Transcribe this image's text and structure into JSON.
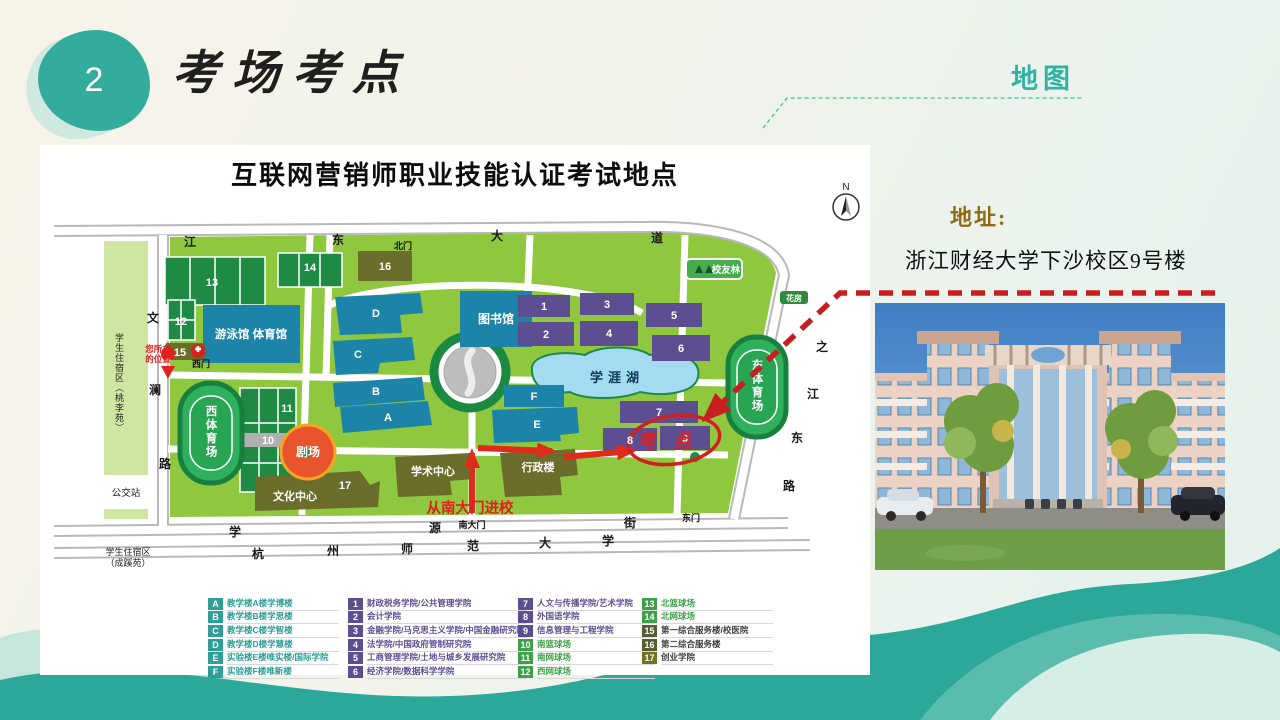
{
  "slide": {
    "number": "2",
    "title": "考场考点",
    "tab": "地图"
  },
  "address": {
    "label": "地址:",
    "value": "浙江财经大学下沙校区9号楼"
  },
  "map": {
    "title": "互联网营销师职业技能认证考试地点",
    "compass": "N",
    "gates": {
      "north": "北门",
      "south": "南大门",
      "east": "东门",
      "west": "西门"
    },
    "roads": {
      "top": [
        "江",
        "东",
        "大",
        "道"
      ],
      "right": [
        "之",
        "江",
        "东",
        "路"
      ],
      "left": [
        "文",
        "澜",
        "路"
      ],
      "street": [
        "学",
        "源",
        "街"
      ],
      "university": [
        "杭",
        "州",
        "师",
        "范",
        "大",
        "学"
      ]
    },
    "places": {
      "swim": "游泳馆 体育馆",
      "library": "图书馆",
      "lake": "学涯湖",
      "west_stadium": "西体育场",
      "east_stadium": "东体育场",
      "alumni": "校友林",
      "flower": "花房",
      "theater": "剧场",
      "culture": "文化中心",
      "academic": "学术中心",
      "admin": "行政楼",
      "exam": "考点",
      "route": "从南大门进校",
      "you_are_here_1": "您所在",
      "you_are_here_2": "的位置",
      "bus": "公交站",
      "dorm_west": "学生住宿区（桃李苑）",
      "dorm_south_1": "学生住宿区",
      "dorm_south_2": "（成蹊苑）"
    },
    "ids": {
      "A": "A",
      "B": "B",
      "C": "C",
      "D": "D",
      "E": "E",
      "F": "F",
      "n1": "1",
      "n2": "2",
      "n3": "3",
      "n4": "4",
      "n5": "5",
      "n6": "6",
      "n7": "7",
      "n8": "8",
      "n9": "9",
      "n10": "10",
      "n11": "11",
      "n12": "12",
      "n13": "13",
      "n14": "14",
      "n15": "15",
      "n16": "16",
      "n17": "17"
    }
  },
  "legend": {
    "columns": [
      {
        "items": [
          {
            "code": "A",
            "label": "教学楼A楼学博楼",
            "badge": "#2e9e97",
            "fg": "#2e9e97"
          },
          {
            "code": "B",
            "label": "教学楼B楼学思楼",
            "badge": "#2e9e97",
            "fg": "#2e9e97"
          },
          {
            "code": "C",
            "label": "教学楼C楼学智楼",
            "badge": "#2e9e97",
            "fg": "#2e9e97"
          },
          {
            "code": "D",
            "label": "教学楼D楼学慧楼",
            "badge": "#2e9e97",
            "fg": "#2e9e97"
          },
          {
            "code": "E",
            "label": "实验楼E楼唯实楼/国际学院",
            "badge": "#2e9e97",
            "fg": "#2e9e97"
          },
          {
            "code": "F",
            "label": "实验楼F楼唯新楼",
            "badge": "#2e9e97",
            "fg": "#2e9e97"
          }
        ]
      },
      {
        "items": [
          {
            "code": "1",
            "label": "财政税务学院/公共管理学院",
            "badge": "#5c4e90",
            "fg": "#5c4e90"
          },
          {
            "code": "2",
            "label": "会计学院",
            "badge": "#5c4e90",
            "fg": "#5c4e90"
          },
          {
            "code": "3",
            "label": "金融学院/马克思主义学院/中国金融研究院",
            "badge": "#5c4e90",
            "fg": "#5c4e90"
          },
          {
            "code": "4",
            "label": "法学院/中国政府管制研究院",
            "badge": "#5c4e90",
            "fg": "#5c4e90"
          },
          {
            "code": "5",
            "label": "工商管理学院/土地与城乡发展研究院",
            "badge": "#5c4e90",
            "fg": "#5c4e90"
          },
          {
            "code": "6",
            "label": "经济学院/数据科学学院",
            "badge": "#5c4e90",
            "fg": "#5c4e90"
          }
        ]
      },
      {
        "items": [
          {
            "code": "7",
            "label": "人文与传播学院/艺术学院",
            "badge": "#5c4e90",
            "fg": "#5c4e90"
          },
          {
            "code": "8",
            "label": "外国语学院",
            "badge": "#5c4e90",
            "fg": "#5c4e90"
          },
          {
            "code": "9",
            "label": "信息管理与工程学院",
            "badge": "#5c4e90",
            "fg": "#5c4e90"
          },
          {
            "code": "10",
            "label": "南篮球场",
            "badge": "#3fa04a",
            "fg": "#3fa04a"
          },
          {
            "code": "11",
            "label": "南网球场",
            "badge": "#3fa04a",
            "fg": "#3fa04a"
          },
          {
            "code": "12",
            "label": "西网球场",
            "badge": "#3fa04a",
            "fg": "#3fa04a"
          }
        ]
      },
      {
        "items": [
          {
            "code": "13",
            "label": "北篮球场",
            "badge": "#3fa04a",
            "fg": "#3fa04a"
          },
          {
            "code": "14",
            "label": "北网球场",
            "badge": "#3fa04a",
            "fg": "#3fa04a"
          },
          {
            "code": "15",
            "label": "第一综合服务楼/校医院",
            "badge": "#585c36",
            "fg": "#3f3f3f"
          },
          {
            "code": "16",
            "label": "第二综合服务楼",
            "badge": "#585c36",
            "fg": "#3f3f3f"
          },
          {
            "code": "17",
            "label": "创业学院",
            "badge": "#6f7221",
            "fg": "#3f3f3f"
          }
        ]
      }
    ]
  },
  "colors": {
    "teal": "#2ba89a",
    "red": "#c81e1e",
    "gold": "#8f6b14",
    "campus_green": "#8fc73f",
    "building_blue": "#1b84a8",
    "building_purple": "#5c4e90",
    "building_olive": "#6b6d2a"
  }
}
